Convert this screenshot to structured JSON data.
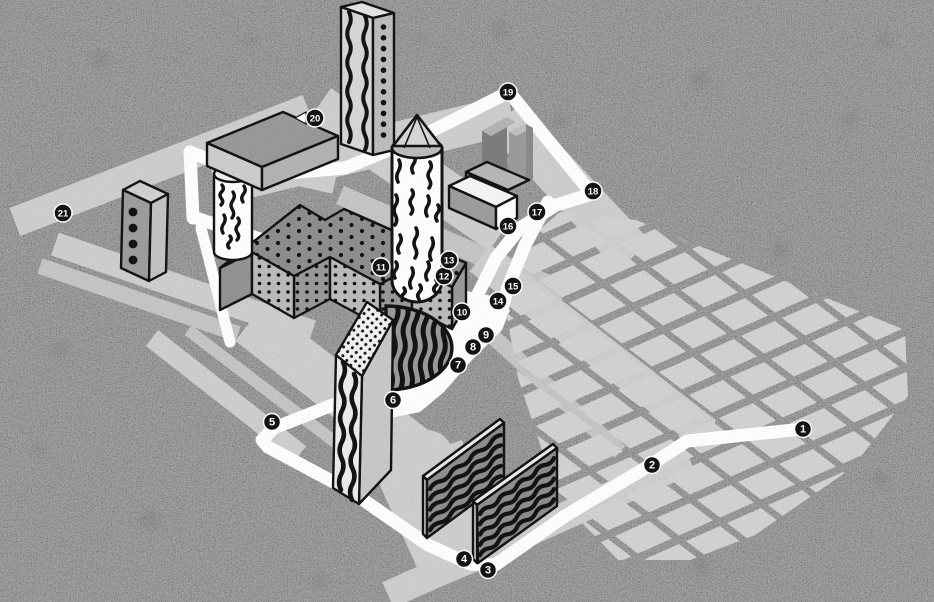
{
  "map": {
    "type": "illustrated-walking-tour-map",
    "background_color": "#9d9d9d",
    "road_color": "#cfcfcf",
    "road_color_dim": "#c6c6c6",
    "block_color": "#d3d3d3",
    "block_color_dark": "#a9a9a9",
    "path_color": "#ffffff",
    "ink_color": "#141414",
    "badge_fill": "#141414",
    "badge_ring": "#ffffff",
    "badge_text_color": "#ffffff",
    "stop_count": 21,
    "badges": [
      {
        "label": "1",
        "x": 803,
        "y": 429
      },
      {
        "label": "2",
        "x": 652,
        "y": 465
      },
      {
        "label": "3",
        "x": 488,
        "y": 570
      },
      {
        "label": "4",
        "x": 464,
        "y": 559
      },
      {
        "label": "5",
        "x": 272,
        "y": 422
      },
      {
        "label": "6",
        "x": 393,
        "y": 400
      },
      {
        "label": "7",
        "x": 458,
        "y": 365
      },
      {
        "label": "8",
        "x": 473,
        "y": 347
      },
      {
        "label": "9",
        "x": 486,
        "y": 335
      },
      {
        "label": "10",
        "x": 462,
        "y": 312
      },
      {
        "label": "11",
        "x": 381,
        "y": 267
      },
      {
        "label": "12",
        "x": 444,
        "y": 276
      },
      {
        "label": "13",
        "x": 449,
        "y": 260
      },
      {
        "label": "14",
        "x": 498,
        "y": 301
      },
      {
        "label": "15",
        "x": 513,
        "y": 286
      },
      {
        "label": "16",
        "x": 508,
        "y": 226
      },
      {
        "label": "17",
        "x": 537,
        "y": 212
      },
      {
        "label": "18",
        "x": 593,
        "y": 191
      },
      {
        "label": "19",
        "x": 508,
        "y": 92
      },
      {
        "label": "20",
        "x": 315,
        "y": 118
      },
      {
        "label": "21",
        "x": 63,
        "y": 213
      }
    ]
  }
}
